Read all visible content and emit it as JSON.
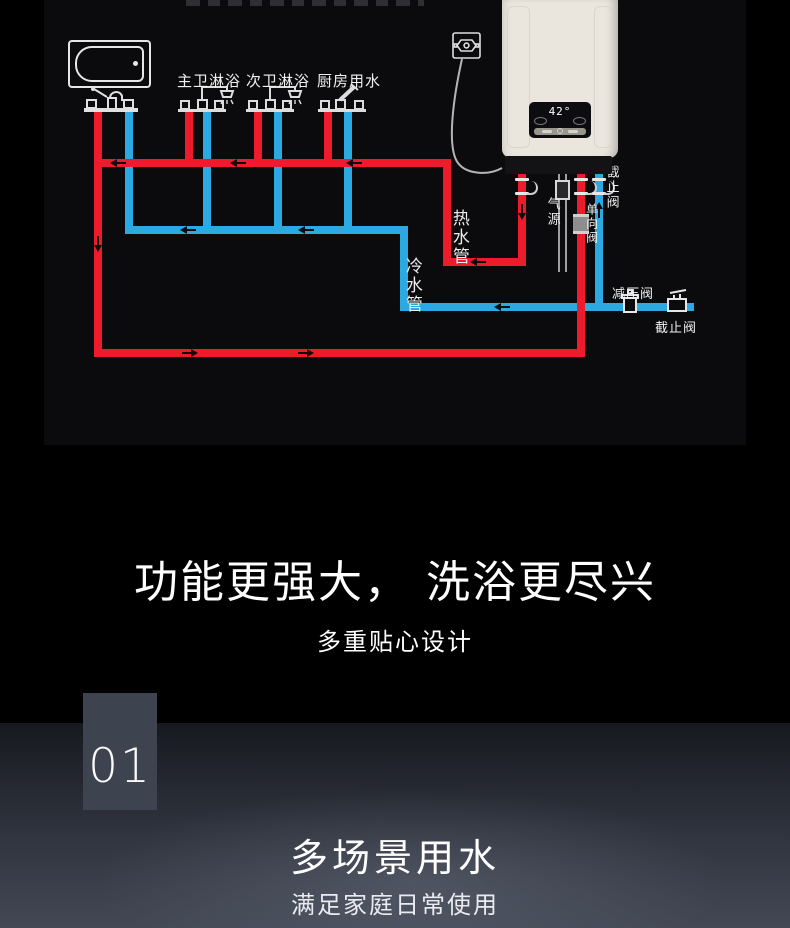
{
  "diagram": {
    "bg_color": "#0b0b0d",
    "hot_pipe_color": "#ee1b2c",
    "cold_pipe_color": "#2aa9e2",
    "fixture_labels": [
      "主卫淋浴",
      "次卫淋浴",
      "厨房用水"
    ],
    "pipe_labels": {
      "hot": "热水管",
      "cold": "冷水管"
    },
    "valve_labels": {
      "stop_valve_top": "截止阀",
      "gas_source": "气源",
      "check_valve": "单向阀",
      "pressure_reducing_valve": "减压阀",
      "stop_valve_bottom": "截止阀"
    },
    "heater": {
      "display_temp": "42°"
    }
  },
  "features_section": {
    "title": "功能更强大， 洗浴更尽兴",
    "subtitle": "多重贴心设计"
  },
  "scene_section": {
    "index": "01",
    "title": "多场景用水",
    "subtitle": "满足家庭日常使用"
  }
}
